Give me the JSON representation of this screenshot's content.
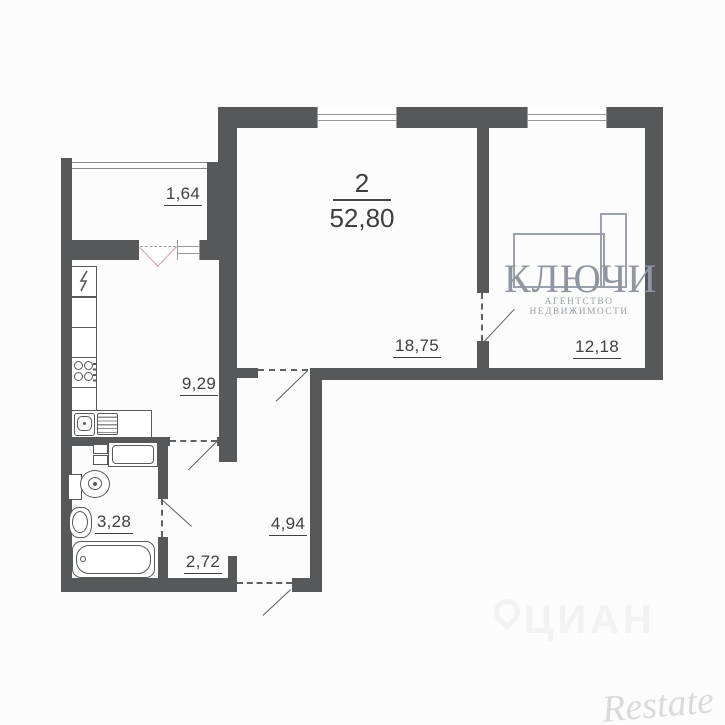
{
  "plan": {
    "rooms_count": "2",
    "total_area": "52,80",
    "areas": {
      "balcony": "1,64",
      "kitchen": "9,29",
      "living_room": "18,75",
      "bedroom": "12,18",
      "bathroom": "3,28",
      "hallway": "4,94",
      "corridor": "2,72"
    }
  },
  "watermarks": {
    "agency_name": "КЛЮЧИ",
    "agency_tagline": "АГЕНТСТВО НЕДВИЖИМОСТИ",
    "portal": "ЦИАН",
    "brand": "Restate"
  },
  "colors": {
    "wall": "#57585a",
    "label_text": "#3e4043",
    "agency_gray": "#949ba5",
    "portal_faint": "#f2f2f4",
    "brand_gray": "#d9dadc",
    "background": "#fcfcfc"
  }
}
